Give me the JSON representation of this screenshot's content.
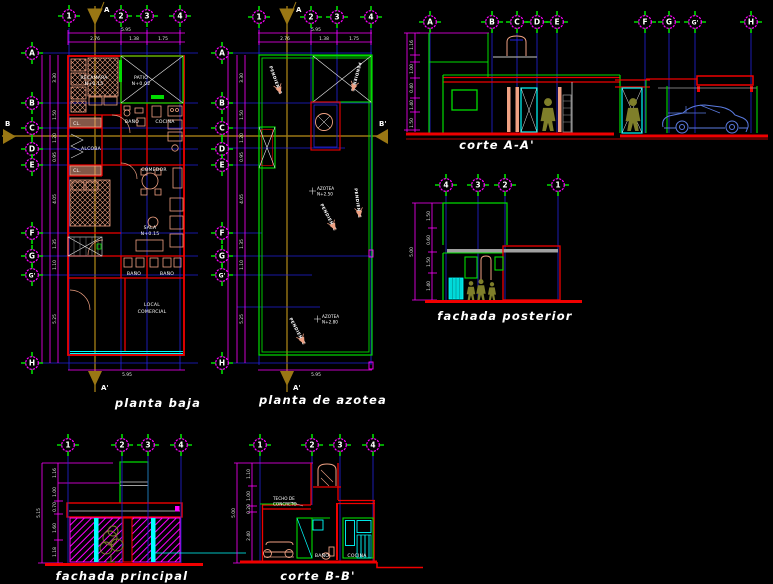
{
  "grid": {
    "cols": [
      "1",
      "2",
      "3",
      "4"
    ],
    "cols_rev": [
      "4",
      "3",
      "2",
      "1"
    ],
    "rows": [
      "A",
      "B",
      "C",
      "D",
      "E",
      "F",
      "G",
      "G'",
      "H"
    ]
  },
  "titles": {
    "planta_baja": "planta baja",
    "planta_azotea": "planta de azotea",
    "corte_aa": "corte A-A'",
    "fachada_posterior": "fachada posterior",
    "fachada_principal": "fachada principal",
    "corte_bb": "corte B-B'"
  },
  "section_markers": {
    "a": "A",
    "a_prime": "A'",
    "b": "B",
    "b_prime": "B'"
  },
  "planta_baja": {
    "rooms": {
      "recamara": "RECAMARA",
      "recamara_lvl": "N+0.15",
      "patio": "PATIO",
      "patio_lvl": "N+0.02",
      "closet1": "CL.",
      "bano": "BAÑO",
      "cocina": "COCINA",
      "alcoba": "ALCOBA",
      "closet2": "CL.",
      "comedor": "COMEDOR",
      "sala": "SALA",
      "sala_lvl": "N+0.15",
      "bano2": "BAÑO",
      "bano3": "BAÑO",
      "local1": "LOCAL",
      "local2": "COMERCIAL"
    },
    "dims_top": {
      "total": "5.95",
      "d1": "2.76",
      "d2": "1.38",
      "d3": "1.75"
    },
    "dims_left": [
      "3.30",
      "1.50",
      "1.20",
      "0.95",
      "4.05",
      "1.35",
      "1.10",
      "5.25"
    ]
  },
  "planta_azotea": {
    "notes": {
      "pendiente": "PENDIENTE",
      "azotea1": "AZOTEA",
      "azotea1_lvl": "N+2.50",
      "azotea2": "AZOTEA",
      "azotea2_lvl": "N+2.80"
    },
    "dims_top": {
      "total": "5.95",
      "d1": "2.76",
      "d2": "1.38",
      "d3": "1.75"
    },
    "dims_left": [
      "3.30",
      "1.50",
      "1.20",
      "0.95",
      "4.05",
      "1.35",
      "1.10",
      "5.25"
    ]
  },
  "corte_aa": {
    "dims": [
      "1.16",
      "1.00",
      "0.40",
      "1.40",
      "1.50"
    ]
  },
  "fachada_posterior": {
    "dims": [
      "1.50",
      "0.60",
      "1.50",
      "1.40"
    ],
    "total": "5.00"
  },
  "fachada_principal": {
    "dims": [
      "1.16",
      "1.00",
      "0.70",
      "1.60",
      "1.18"
    ],
    "total": "5.15"
  },
  "corte_bb": {
    "dims": [
      "1.10",
      "1.00",
      "0.20",
      "2.40"
    ],
    "total": "5.00",
    "labels": {
      "bano": "BAÑO",
      "cocina": "COCINA",
      "nota1": "TECHO DE",
      "nota2": "CONCRETO"
    }
  }
}
